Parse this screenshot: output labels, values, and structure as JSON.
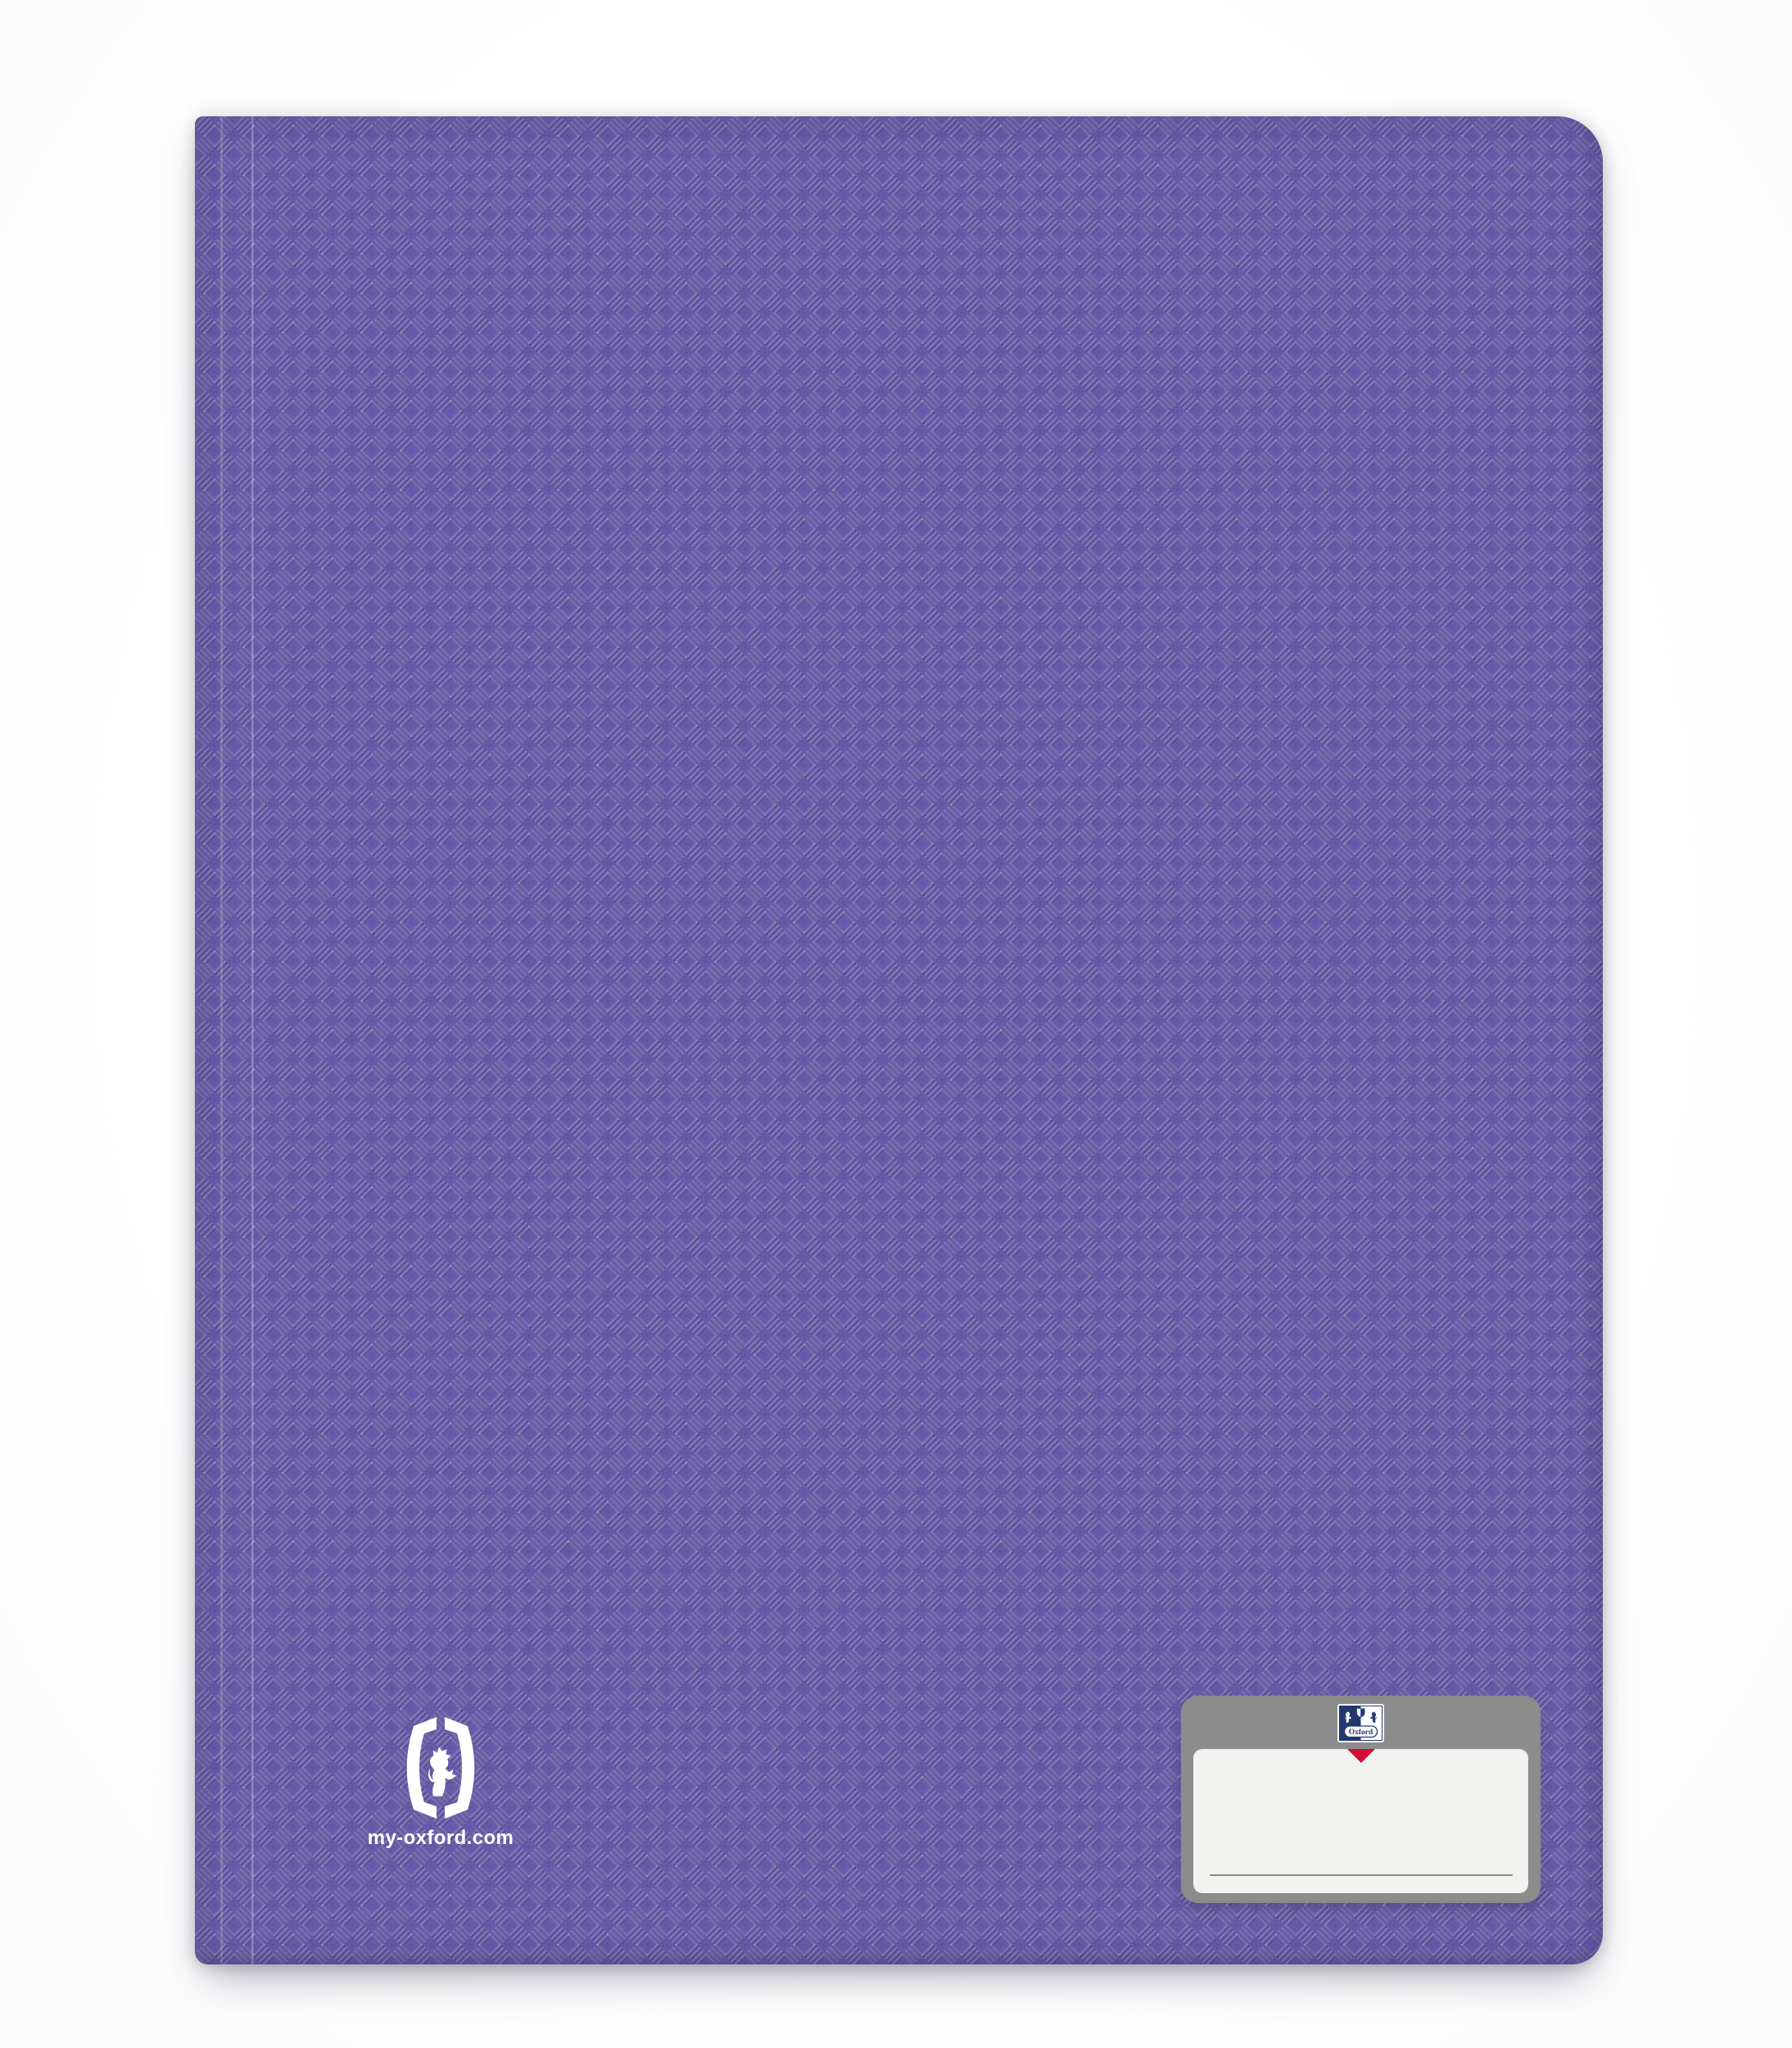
{
  "product": {
    "kind": "display-book-front-cover",
    "brand": "Oxford",
    "cover_color": "#675BA9",
    "texture": "basketweave-emboss",
    "texture_light": "rgba(255,255,255,0.16)",
    "texture_dark": "rgba(0,0,0,0.10)"
  },
  "branding": {
    "website": "my-oxford.com",
    "website_color": "#FFFFFF",
    "lion_logo_color": "#FFFFFF"
  },
  "crest": {
    "wordmark": "Oxford",
    "navy": "#24366E",
    "white": "#FFFFFF"
  },
  "name_label": {
    "plate_color": "#8C8C8C",
    "label_color": "#F2F2F0",
    "arrow_color": "#D30D33",
    "line_color": "#8A8A8A",
    "name_value": ""
  }
}
